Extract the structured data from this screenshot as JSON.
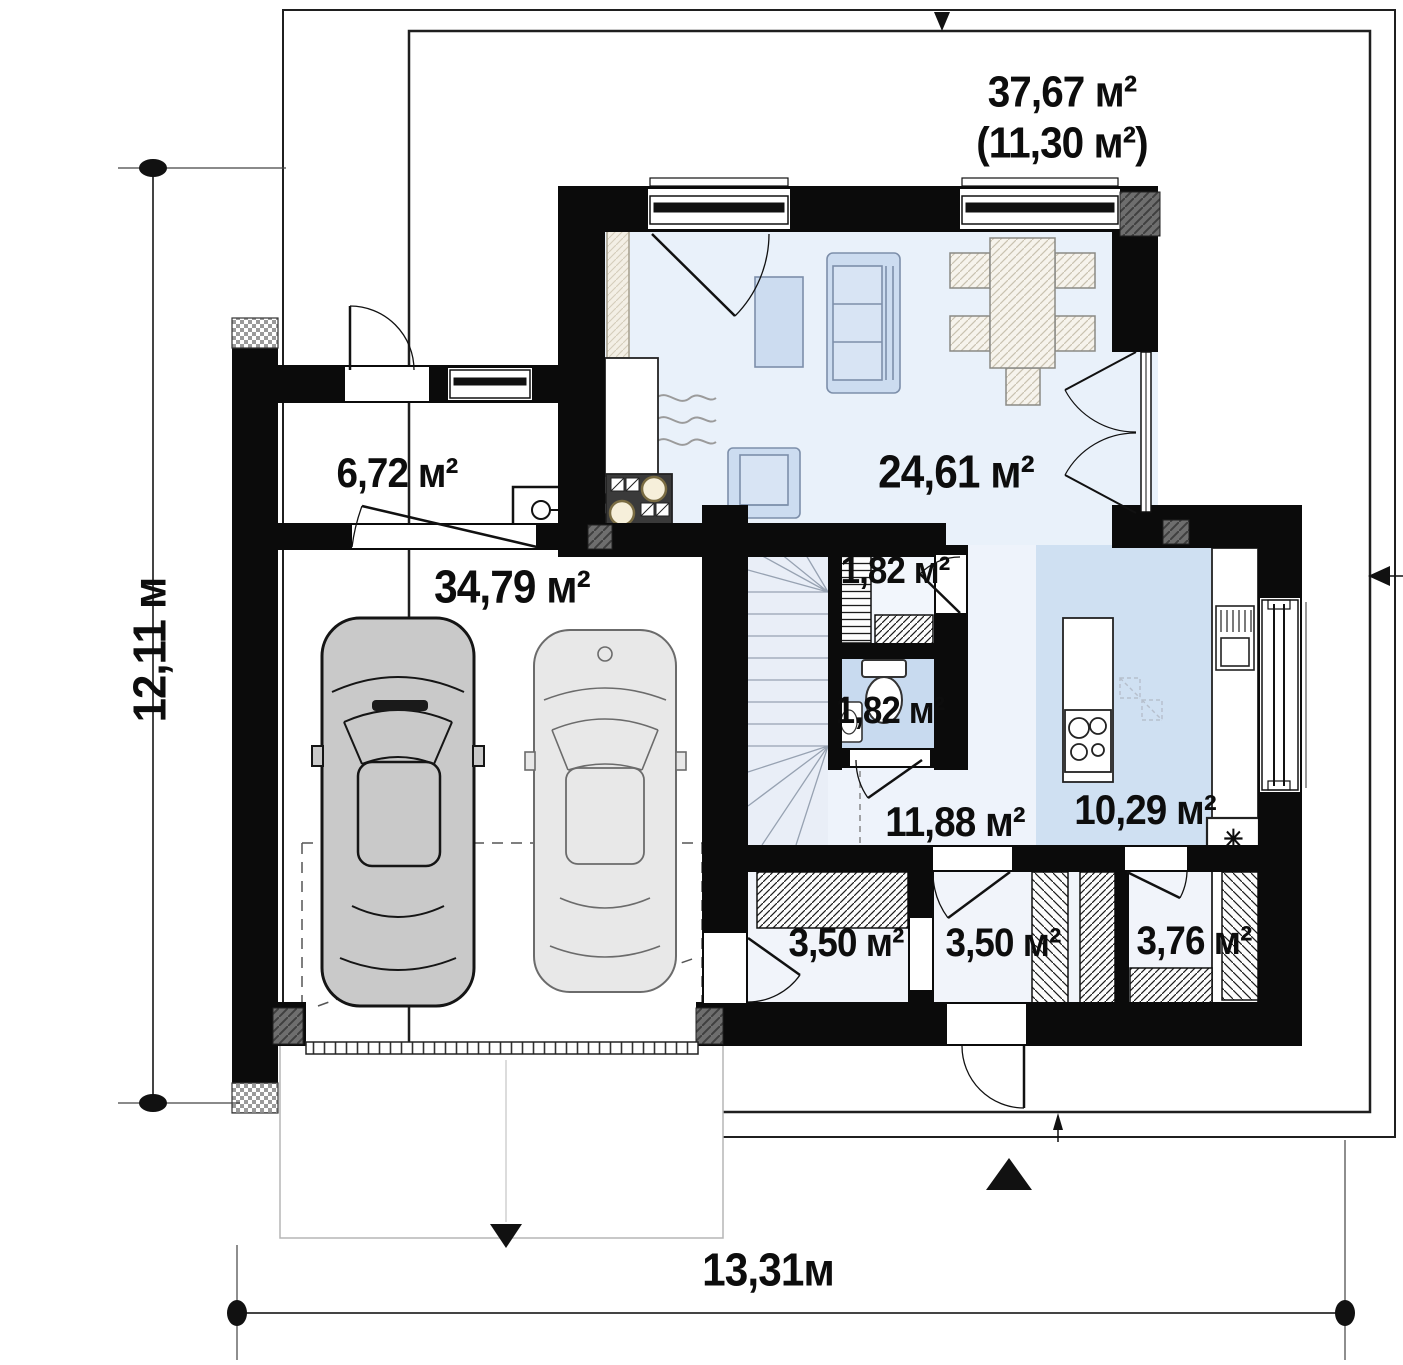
{
  "terrace": {
    "area": "37,67 м²",
    "area_secondary": "(11,30 м²)"
  },
  "rooms": [
    {
      "name": "living-room",
      "area": "24,61 м²"
    },
    {
      "name": "utility",
      "area": "6,72 м²"
    },
    {
      "name": "garage",
      "area": "34,79 м²"
    },
    {
      "name": "closet",
      "area": "1,82 м²"
    },
    {
      "name": "wc",
      "area": "1,82 м²"
    },
    {
      "name": "hall",
      "area": "11,88 м²"
    },
    {
      "name": "kitchen",
      "area": "10,29 м²"
    },
    {
      "name": "wardrobe",
      "area": "3,50 м²"
    },
    {
      "name": "vestibule",
      "area": "3,50 м²"
    },
    {
      "name": "storage",
      "area": "3,76 м²"
    }
  ],
  "dimensions": {
    "height_label": "12,11 м",
    "width_label": "13,31м"
  },
  "symbols": {
    "fridge": "✳"
  },
  "colors": {
    "wall": "#0b0b0b",
    "room_fill": "#e9f1fa",
    "kitchen_fill": "#cfe0f2",
    "wc_fill": "#c8daef",
    "furniture_fill": "#ccdcf0",
    "burner": "#f6efda",
    "junction_block": "#6e6e6e"
  }
}
